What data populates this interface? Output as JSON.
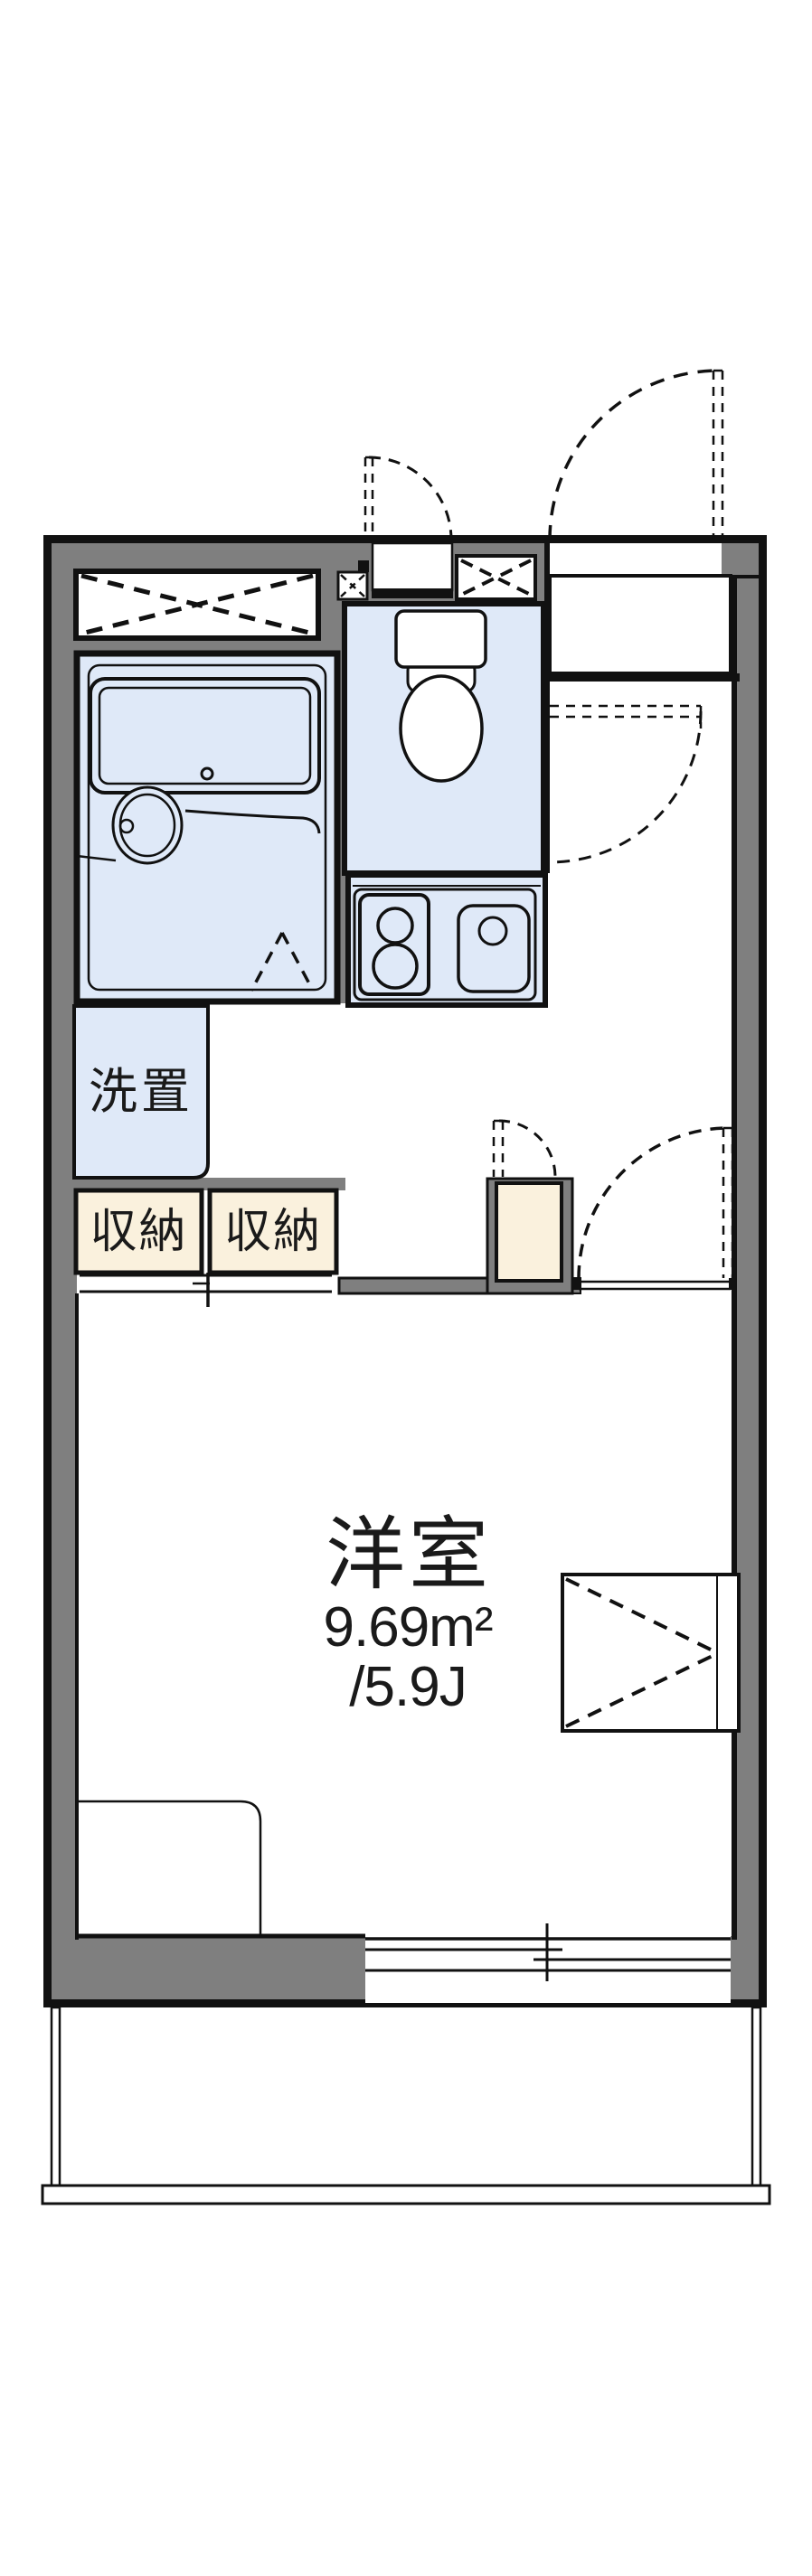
{
  "floorplan": {
    "rooms": {
      "main_room": {
        "name": "洋室",
        "area_sqm": "9.69m²",
        "area_tatami": "/5.9J"
      },
      "washer_space": {
        "label": "洗置"
      },
      "storage_left": {
        "label": "収納"
      },
      "storage_right": {
        "label": "収納"
      }
    },
    "colors": {
      "wall_gray": "#7f7f7f",
      "fixture_blue": "#dfe9f8",
      "storage_cream": "#faf1dd",
      "line": "#111111",
      "background": "#ffffff"
    }
  }
}
